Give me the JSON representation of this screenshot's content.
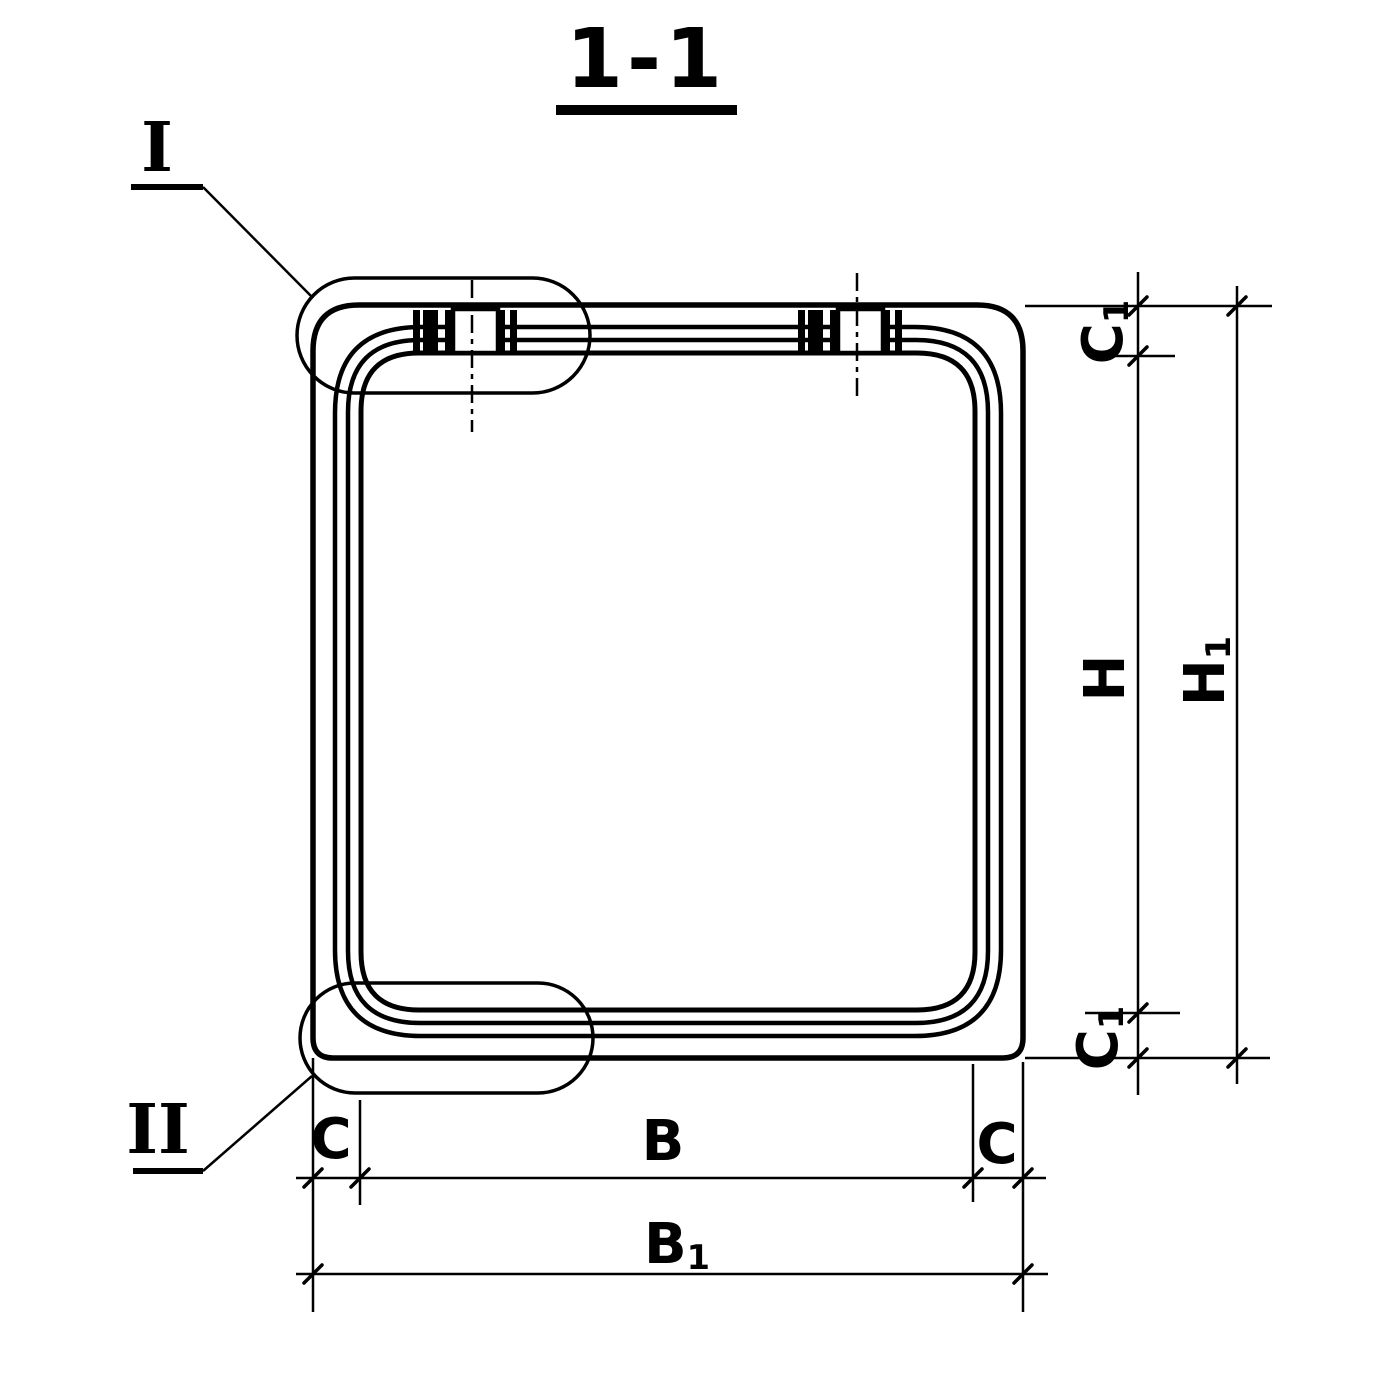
{
  "colors": {
    "ink": "#000000",
    "paper": "#ffffff"
  },
  "title": {
    "label": "1-1"
  },
  "callouts": {
    "detail_one": "I",
    "detail_two": "II"
  },
  "dimension_labels": {
    "b": "B",
    "b1_base": "B",
    "b1_sub": "1",
    "c": "C",
    "c1_base": "C",
    "c1_sub": "1",
    "h": "H",
    "h1_base": "H",
    "h1_sub": "1"
  }
}
